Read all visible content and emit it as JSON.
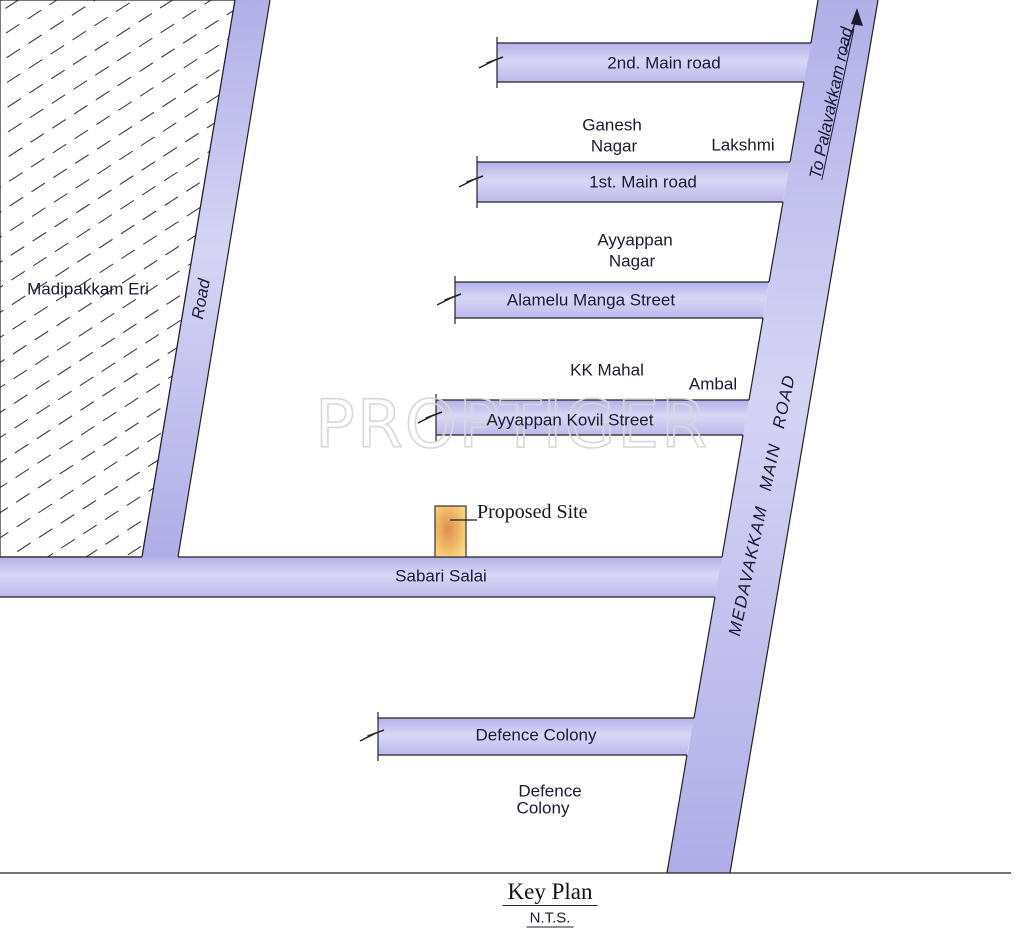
{
  "map": {
    "title": "Key Plan",
    "scale_note": "N.T.S.",
    "watermark": "PROPTIGER",
    "site": {
      "label": "Proposed Site"
    },
    "roads": {
      "second_main": "2nd. Main road",
      "first_main": "1st. Main road",
      "alamelu": "Alamelu Manga Street",
      "ayyappan_kovil": "Ayyappan Kovil Street",
      "sabari": "Sabari Salai",
      "defence": "Defence Colony",
      "left_road": "Road",
      "medavakkam": "MEDAVAKKAM MAIN ROAD",
      "to_palavakkam": "To Palavakkam road"
    },
    "areas": {
      "madipakkam_eri": "Madipakkam Eri",
      "ganesh_nagar_line1": "Ganesh",
      "ganesh_nagar_line2": "Nagar",
      "lakshmi": "Lakshmi",
      "ayyappan_nagar_line1": "Ayyappan",
      "ayyappan_nagar_line2": "Nagar",
      "kk_mahal": "KK Mahal",
      "ambal": "Ambal",
      "defence_colony_line1": "Defence",
      "defence_colony_line2": "Colony"
    },
    "colors": {
      "road_fill_light": "#d7d5f5",
      "road_fill_dark": "#b2afe8",
      "road_edge": "#222222",
      "label_text": "#1b1a33",
      "site_center": "#dd8f54",
      "site_edge": "#fbe294",
      "watermark_stroke": "#d8d8d8"
    }
  }
}
